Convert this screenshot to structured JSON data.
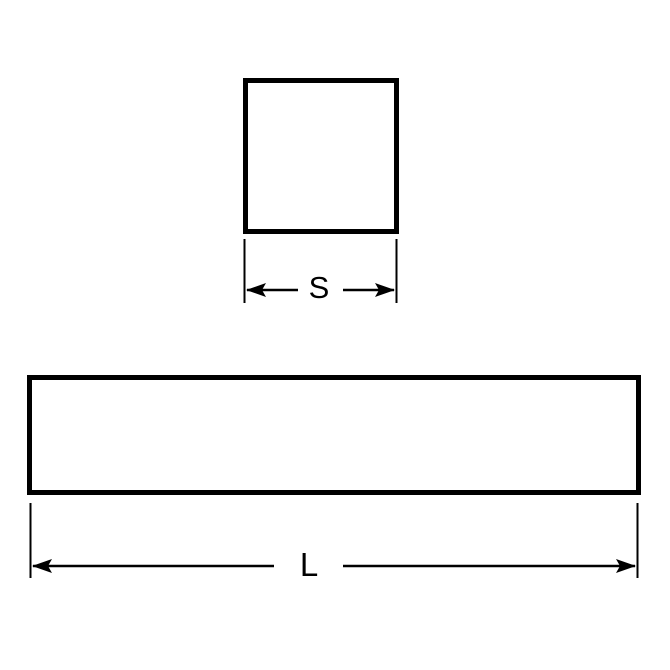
{
  "page": {
    "background_color": "#ffffff"
  },
  "diagram": {
    "line_color": "#000000",
    "cross_section_view": {
      "dimension_label": "S"
    },
    "side_view": {
      "dimension_label": "L"
    }
  }
}
